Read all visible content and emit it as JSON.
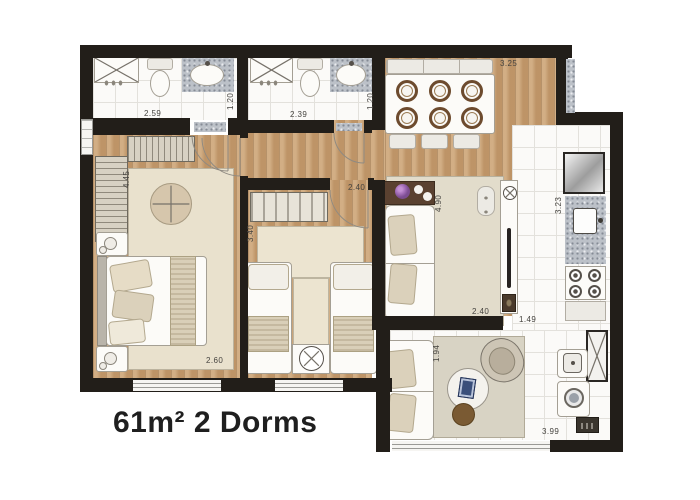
{
  "title": "61m² 2 Dorms",
  "dimensions": {
    "bathroom1": {
      "width": "2.59",
      "depth": "1.20"
    },
    "bathroom2": {
      "width": "2.39",
      "depth": "1.20"
    },
    "dining": {
      "width": "3.25"
    },
    "master_bedroom": {
      "length": "4.45",
      "width": "2.60"
    },
    "bedroom2": {
      "width": "2.40",
      "length": "3.40"
    },
    "living": {
      "length": "4.90",
      "width": "2.40"
    },
    "kitchen": {
      "length": "3.23",
      "width": "1.49"
    },
    "balcony_living": {
      "depth": "1.94",
      "width": "3.99"
    }
  },
  "colors": {
    "wall": "#221e19",
    "wood_floor": "#c59d70",
    "tile_floor": "#fbfaf8",
    "rug": "#e7dfcc",
    "granite": "#bcc1c8",
    "flower_accent": "#a06bb5",
    "pouf_brown": "#7a5a33",
    "title_text": "#1f1f1f"
  },
  "fixtures": [
    "shower-box",
    "toilet",
    "vanity-sink",
    "towel-hooks",
    "dining-table-six-plates",
    "dining-bench",
    "dining-chairs",
    "wardrobe-hangers",
    "wardrobe-shelves",
    "round-ottoman",
    "double-bed",
    "nightstand-lamp",
    "single-bed",
    "fan-side-table",
    "console-table-flowers",
    "sofa",
    "counter-sink",
    "bar-stool",
    "refrigerator",
    "kitchen-sink-counter",
    "cooktop-four-burners",
    "coffee-table",
    "floor-pouf",
    "armchair",
    "laundry-tub",
    "washing-machine",
    "water-heater",
    "utility-cabinet",
    "sliding-window",
    "door-swing"
  ]
}
